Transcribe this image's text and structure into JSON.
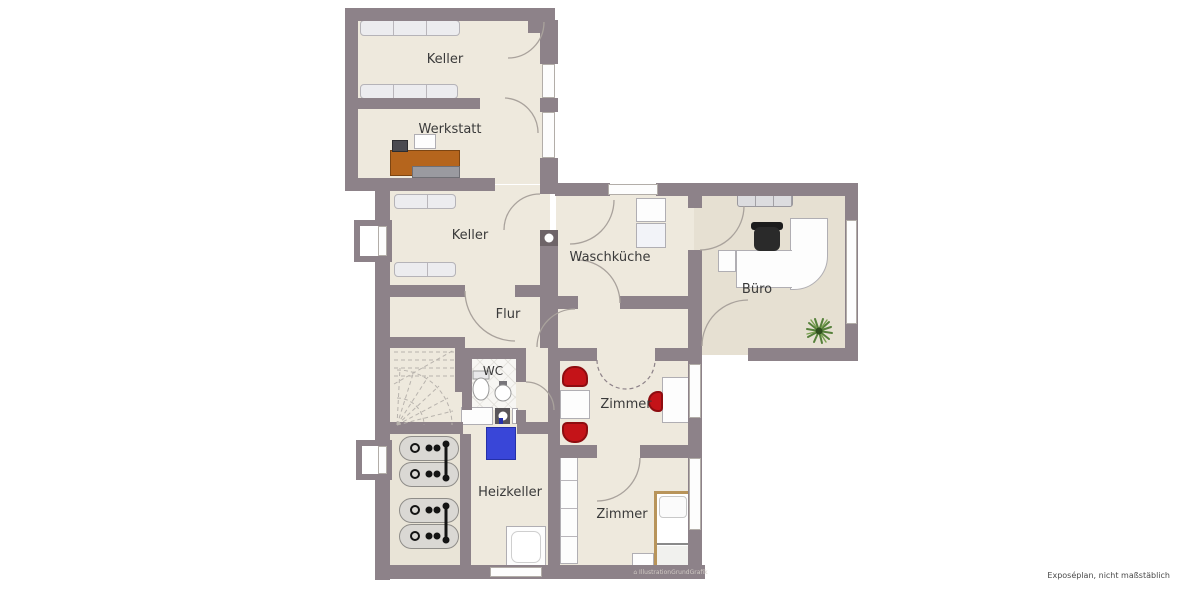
{
  "plan": {
    "type": "floorplan",
    "caption": "Exposéplan, nicht maßstäblich",
    "watermark": "IllustrationGrundGrafik"
  },
  "rooms": {
    "keller_top": {
      "label": "Keller"
    },
    "werkstatt": {
      "label": "Werkstatt"
    },
    "keller_mid": {
      "label": "Keller"
    },
    "waschkueche": {
      "label": "Waschküche"
    },
    "buero": {
      "label": "Büro"
    },
    "flur": {
      "label": "Flur"
    },
    "wc": {
      "label": "WC"
    },
    "zimmer_1": {
      "label": "Zimmer"
    },
    "heizkeller": {
      "label": "Heizkeller"
    },
    "zimmer_2": {
      "label": "Zimmer"
    }
  },
  "colors": {
    "wall": "#8d8289",
    "floor": "#eee9dd",
    "floor_buero": "#e6e0d2",
    "accent_red": "#c41318",
    "accent_blue": "#3946d8",
    "workbench_wood": "#b5651d",
    "bed_wood": "#c8a05e",
    "plant_green": "#55803a"
  }
}
